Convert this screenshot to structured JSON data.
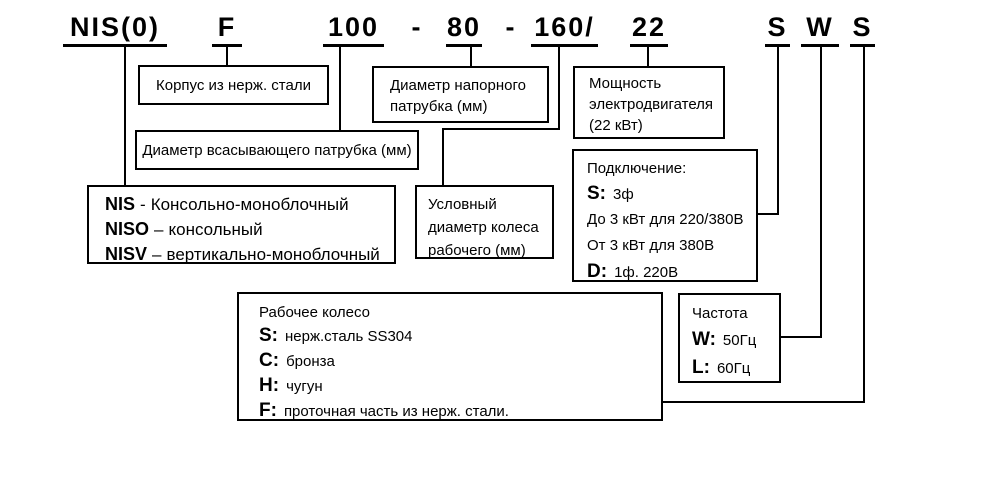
{
  "colors": {
    "ink": "#000000",
    "background": "#ffffff"
  },
  "formula": {
    "series": "NIS(0)",
    "casing": "F",
    "suction_diameter": "100",
    "sep1": "-",
    "discharge_diameter": "80",
    "sep2": "-",
    "impeller_diameter": "160",
    "slash": "/",
    "power": "22",
    "connection": "S",
    "frequency": "W",
    "impeller_material": "S"
  },
  "boxes": {
    "casing": {
      "text": "Корпус из нерж. стали"
    },
    "suction": {
      "text": "Диаметр всасывающего патрубка (мм)"
    },
    "discharge": {
      "lines": [
        "Диаметр напорного",
        "патрубка (мм)"
      ]
    },
    "power": {
      "lines": [
        "Мощность",
        "электродвигателя",
        "(22 кВт)"
      ]
    },
    "series": {
      "lines": [
        {
          "key": "NIS",
          "sep": "-",
          "text": "Консольно-моноблочный"
        },
        {
          "key": "NISO",
          "sep": "–",
          "text": "консольный"
        },
        {
          "key": "NISV",
          "sep": "–",
          "text": "вертикально-моноблочный"
        }
      ]
    },
    "impeller_diameter": {
      "lines": [
        "Условный",
        "диаметр колеса",
        "рабочего (мм)"
      ]
    },
    "connection": {
      "title": "Подключение:",
      "lines": [
        {
          "key": "S:",
          "text": "3ф"
        },
        {
          "key": "",
          "text": "До 3 кВт для 220/380В"
        },
        {
          "key": "",
          "text": "От 3 кВт для 380В"
        },
        {
          "key": "D:",
          "text": "1ф. 220В"
        }
      ]
    },
    "impeller": {
      "title": "Рабочее колесо",
      "lines": [
        {
          "key": "S:",
          "text": "нерж.сталь SS304"
        },
        {
          "key": "C:",
          "text": "бронза"
        },
        {
          "key": "H:",
          "text": "чугун"
        },
        {
          "key": "F:",
          "text": "проточная часть из нерж. стали."
        }
      ]
    },
    "frequency": {
      "title": "Частота",
      "lines": [
        {
          "key": "W:",
          "text": "50Гц"
        },
        {
          "key": "L:",
          "text": "60Гц"
        }
      ]
    }
  }
}
